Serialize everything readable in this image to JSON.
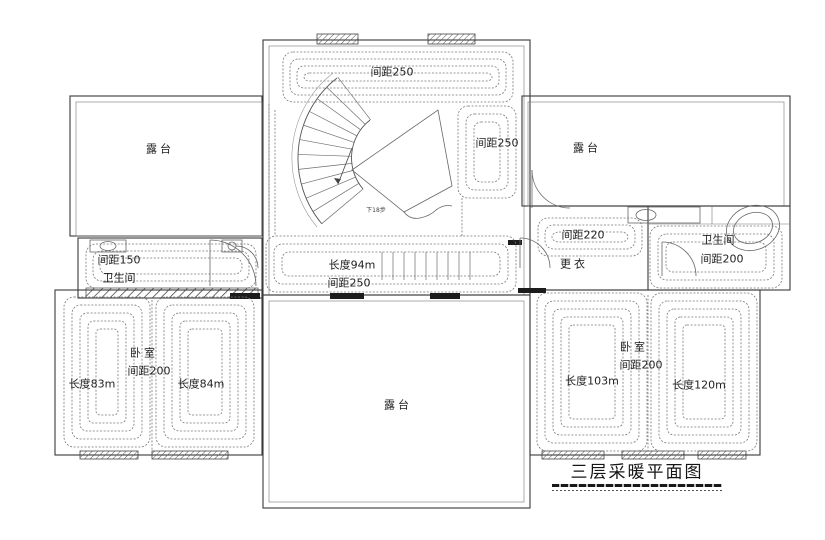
{
  "drawing_title": "三层采暖平面图",
  "rooms": {
    "hall": {
      "top_coil_spacing": "间距250",
      "right_coil_spacing": "间距250",
      "stair_note": "下18步"
    },
    "terrace_left": {
      "name": "露台"
    },
    "terrace_right": {
      "name": "露台"
    },
    "terrace_bottom": {
      "name": "露台"
    },
    "bathroom_left": {
      "spacing": "间距150",
      "name": "卫生间"
    },
    "corridor": {
      "length": "长度94m",
      "spacing": "间距250"
    },
    "dressing": {
      "spacing": "间距220",
      "name": "更衣"
    },
    "bathroom_right": {
      "name": "卫生间",
      "spacing": "间距200"
    },
    "bedroom_left": {
      "name": "卧室",
      "spacing": "间距200",
      "coil1_length": "长度83m",
      "coil2_length": "长度84m"
    },
    "bedroom_right": {
      "name": "卧室",
      "spacing": "间距200",
      "coil1_length": "长度103m",
      "coil2_length": "长度120m"
    }
  },
  "colors": {
    "background": "#ffffff",
    "wall_line": "#3a3a3a",
    "coil_line": "#787878",
    "text": "#1f1f1f"
  }
}
